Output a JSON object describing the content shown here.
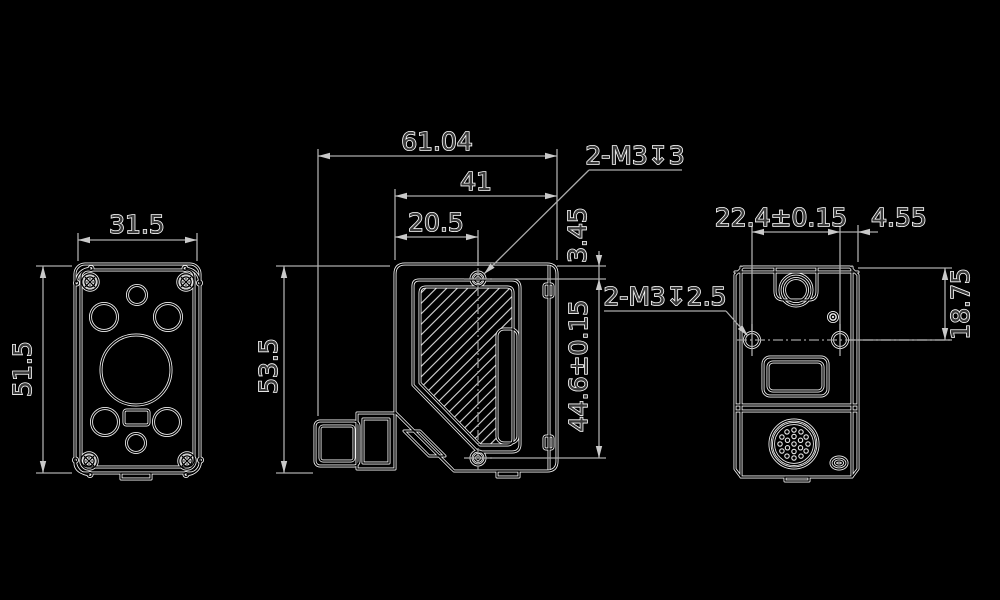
{
  "drawing": {
    "description": "three-view technical dimension drawing of a compact sensor",
    "colors": {
      "background": "#000000",
      "outline": "#f2f2f2",
      "dimension_line": "#ababab",
      "text_fill": "#3a3a3a",
      "text_outline": "#ffffff"
    },
    "dimensions": {
      "front_width": "31.5",
      "front_height": "51.5",
      "side_height": "53.5",
      "total_depth": "61.04",
      "body_depth": "41",
      "front_to_hole": "20.5",
      "top_to_side_hole": "3.45",
      "side_hole_spacing": "44.6±0.15",
      "top_thread_callout": "2-M3↧3",
      "back_thread_callout": "2-M3↧2.5",
      "back_hole_spacing": "22.4±0.15",
      "back_hole_to_edge": "4.55",
      "top_to_back_hole": "18.75"
    }
  }
}
